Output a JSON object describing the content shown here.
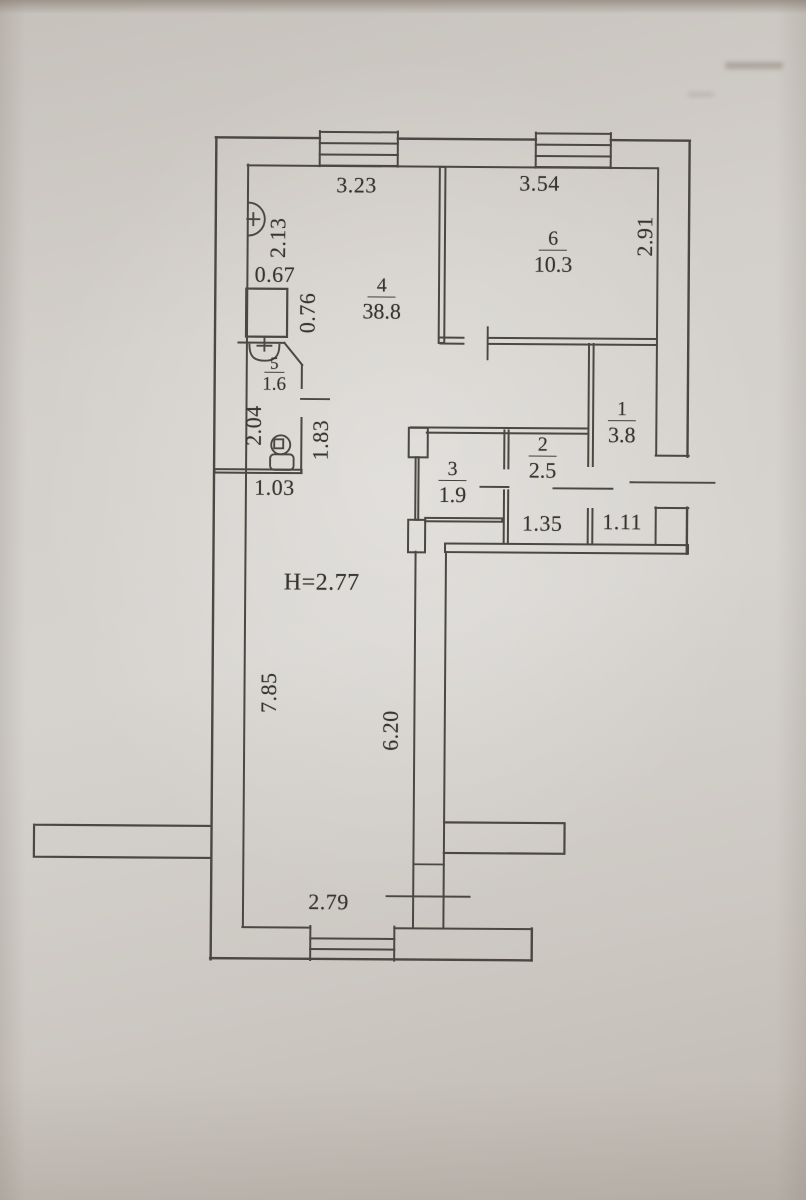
{
  "rooms": [
    {
      "number": "4",
      "area": "38.8"
    },
    {
      "number": "6",
      "area": "10.3"
    },
    {
      "number": "1",
      "area": "3.8"
    },
    {
      "number": "2",
      "area": "2.5"
    },
    {
      "number": "3",
      "area": "1.9"
    },
    {
      "number": "5",
      "area": "1.6"
    }
  ],
  "dims": {
    "top_left": "3.23",
    "top_right": "3.54",
    "right_side": "2.91",
    "left_upper": "2.13",
    "niche_width": "0.67",
    "niche_height": "0.76",
    "bath_height": "2.04",
    "bath_right": "1.83",
    "bath_width": "1.03",
    "hall_width": "1.35",
    "entry_width": "1.11",
    "left_lower": "7.85",
    "mid_wall": "6.20",
    "bottom_width": "2.79",
    "ceiling": "H=2.77"
  }
}
